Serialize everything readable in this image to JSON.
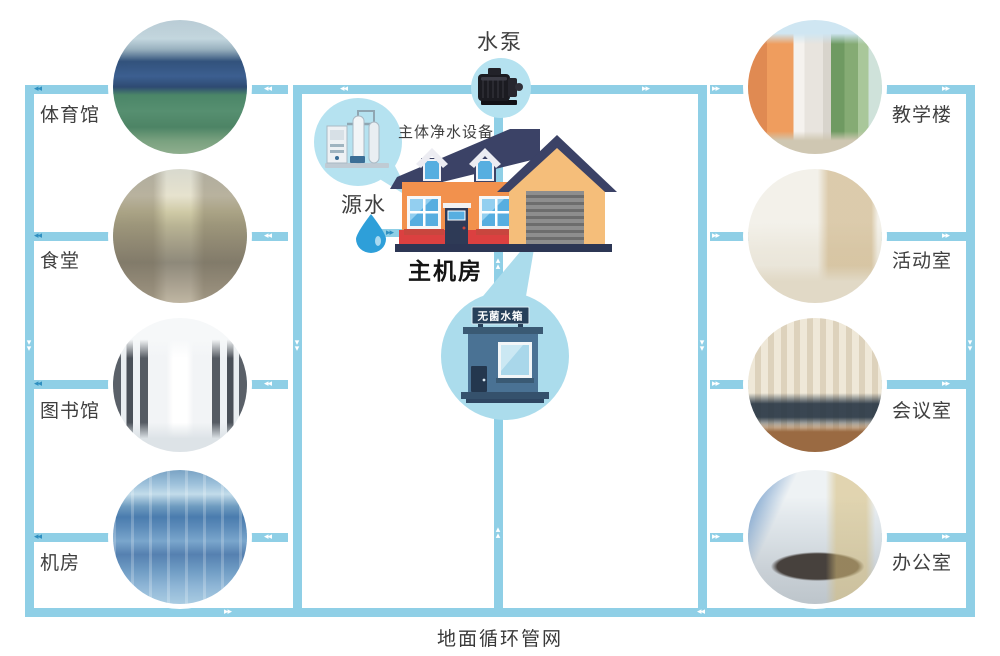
{
  "left_buildings": [
    {
      "label": "体育馆",
      "photo": "gymnasium"
    },
    {
      "label": "食堂",
      "photo": "canteen"
    },
    {
      "label": "图书馆",
      "photo": "library"
    },
    {
      "label": "机房",
      "photo": "computer-room"
    }
  ],
  "right_buildings": [
    {
      "label": "教学楼",
      "photo": "teaching-building"
    },
    {
      "label": "活动室",
      "photo": "activity-room"
    },
    {
      "label": "会议室",
      "photo": "meeting-room"
    },
    {
      "label": "办公室",
      "photo": "office"
    }
  ],
  "center": {
    "pump_label": "水泵",
    "purifier_label": "主体净水设备",
    "source_label": "源水",
    "main_room_label": "主机房",
    "tank_label": "无菌水箱"
  },
  "footer_label": "地面循环管网",
  "colors": {
    "pipe": "#8FCFE6",
    "bubble": "#B5E2F0",
    "tank_bubble": "#ABDCEC",
    "arrow_dark": "#2F8FC0",
    "house_roof": "#3B4266",
    "house_wall": "#F2914D",
    "garage_wall": "#F5BE7A",
    "accent_red": "#DB4040",
    "water_drop": "#2E9FD9",
    "tank_wall": "#4A7294",
    "label_text": "#3F3F3F"
  }
}
